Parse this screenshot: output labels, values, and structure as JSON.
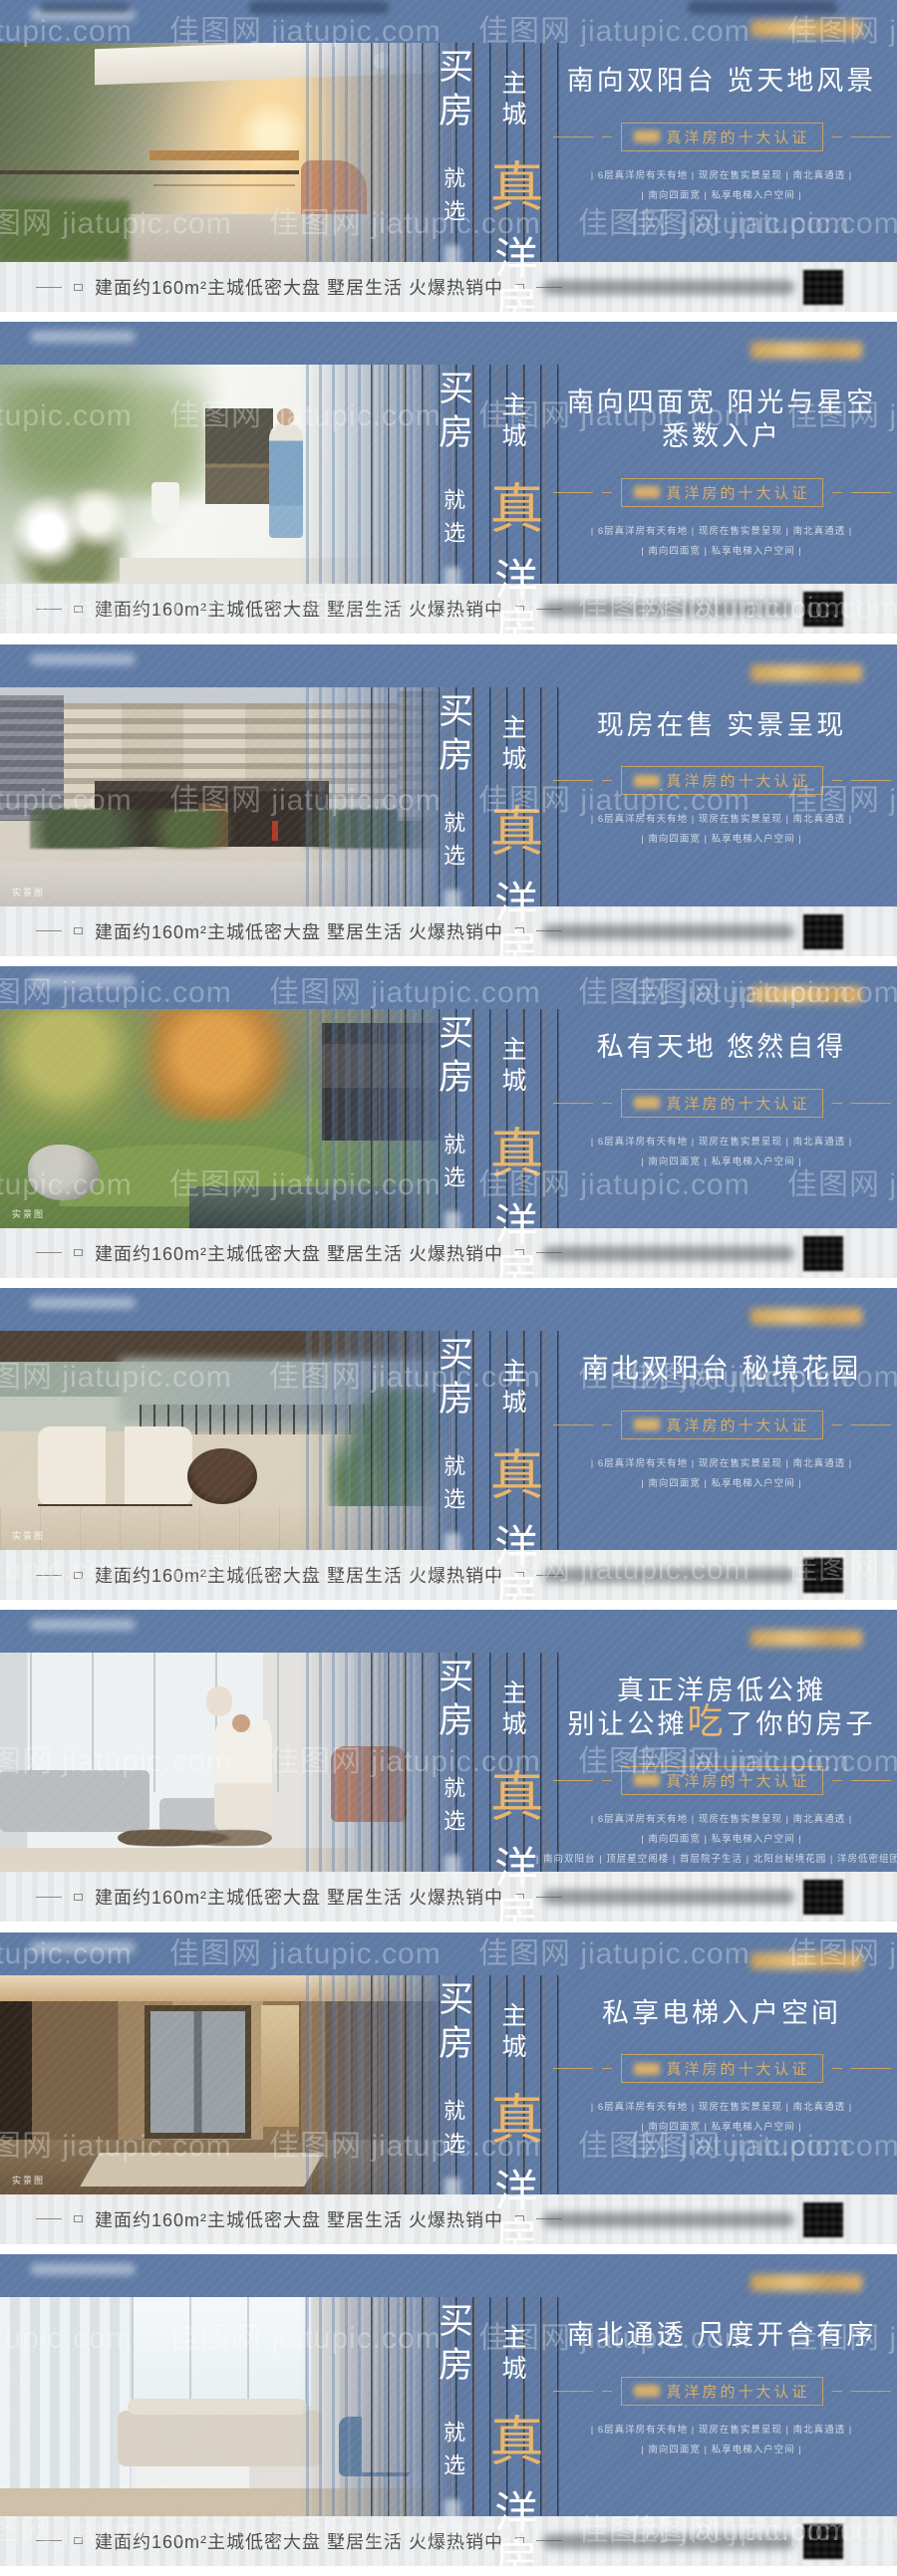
{
  "series": {
    "watermark_text": "佳图网 jiatupic.com",
    "colors": {
      "banner_blue": "#5e7aa5",
      "gold_accent": "#d8b06c",
      "bottom_bar_bg": "#edeff0",
      "bottom_bar_text": "#4c4c4c"
    }
  },
  "shared": {
    "slogan": {
      "col1_main": "买房",
      "col1_sub": "就选",
      "col2_top": "主城",
      "col2_accent": "真",
      "col2_rest": "洋房"
    },
    "badge_label": "真洋房的十大认证",
    "features_line1": "| 6层真洋房有天有地 | 现房在售实景呈现 | 南北真通透 |",
    "features_line2": "| 南向四面宽 | 私享电梯入户空间 |",
    "features_line3": "| 南向双阳台 | 顶层星空阁楼 | 首层院子生活 | 北阳台秘境花园 | 洋房低密组团 |",
    "bottom_bar_text": "建面约160m²主城低密大盘 墅居生活 火爆热销中",
    "photo_tag_label": "实景图"
  },
  "banners": [
    {
      "photo_name": "balcony-terrace-garden-photo",
      "headline_line1": "",
      "headline_pre": "南向双阳台 览天地风景",
      "headline_accent": "",
      "headline_post": "",
      "show_line3": false,
      "show_tag": false
    },
    {
      "photo_name": "woman-painting-balcony-photo",
      "headline_line1": "",
      "headline_pre": "南向四面宽 阳光与星空悉数入户",
      "headline_accent": "",
      "headline_post": "",
      "show_line3": false,
      "show_tag": false
    },
    {
      "photo_name": "residential-building-entrance-photo",
      "headline_line1": "",
      "headline_pre": "现房在售 实景呈现",
      "headline_accent": "",
      "headline_post": "",
      "show_line3": false,
      "show_tag": true
    },
    {
      "photo_name": "courtyard-garden-pond-photo",
      "headline_line1": "",
      "headline_pre": "私有天地 悠然自得",
      "headline_accent": "",
      "headline_post": "",
      "show_line3": false,
      "show_tag": true
    },
    {
      "photo_name": "terrace-lounge-armchairs-photo",
      "headline_line1": "",
      "headline_pre": "南北双阳台 秘境花园",
      "headline_accent": "",
      "headline_post": "",
      "show_line3": false,
      "show_tag": true
    },
    {
      "photo_name": "family-living-room-photo",
      "headline_line1": "真正洋房低公摊",
      "headline_pre": "别让公摊",
      "headline_accent": "吃",
      "headline_post": "了你的房子",
      "show_line3": true,
      "show_tag": false
    },
    {
      "photo_name": "private-elevator-hall-photo",
      "headline_line1": "",
      "headline_pre": "私享电梯入户空间",
      "headline_accent": "",
      "headline_post": "",
      "show_line3": false,
      "show_tag": true
    },
    {
      "photo_name": "bright-living-room-photo",
      "headline_line1": "",
      "headline_pre": "南北通透 尺度开合有序",
      "headline_accent": "",
      "headline_post": "",
      "show_line3": false,
      "show_tag": false
    }
  ]
}
